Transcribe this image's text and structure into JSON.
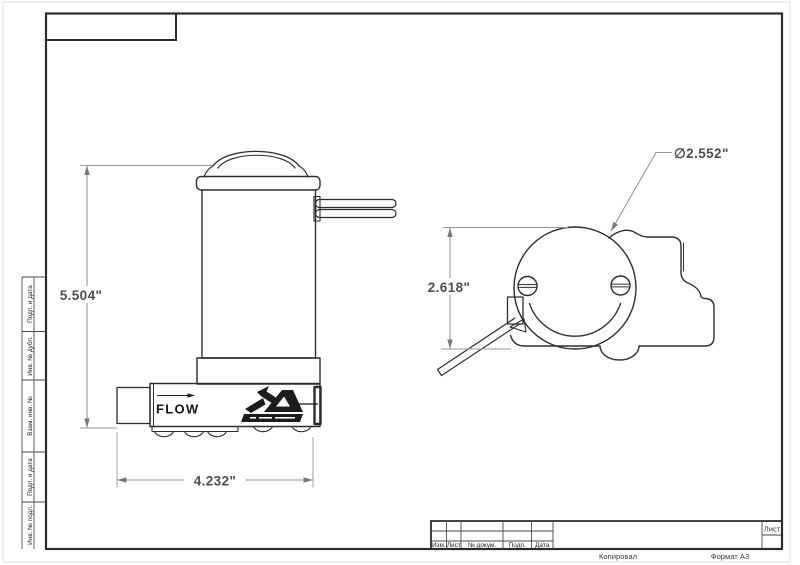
{
  "stamp_sidebar": {
    "labels": [
      "Подп. и дата",
      "Инв. № дубл.",
      "Взам. инв. №",
      "Подп. и дата",
      "Инв. № подл."
    ]
  },
  "title_block": {
    "revision_columns": [
      "Изм.",
      "Лист",
      "№ докум.",
      "Подп.",
      "Дата"
    ],
    "sheet_label": "Лист"
  },
  "footer": {
    "copy_label": "Копировал",
    "format_label": "Формат А3"
  },
  "views": {
    "front": {
      "height_dim": "5.504\"",
      "width_dim": "4.232\"",
      "flow_label": "FLOW"
    },
    "top": {
      "height_dim": "2.618\"",
      "diameter_dim": "∅2.552\""
    }
  },
  "colors": {
    "part_outline": "#2d2d2d",
    "dimension_line": "#8f8f8f",
    "dimension_text": "#4d4d4d",
    "frame": "#2b2b2b"
  }
}
